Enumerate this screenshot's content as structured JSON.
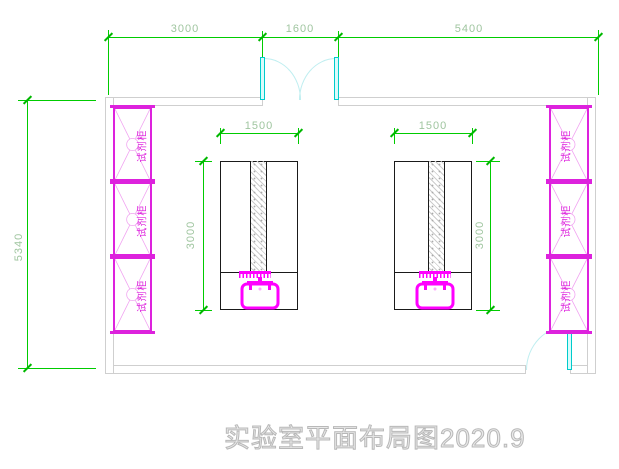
{
  "drawing": {
    "title": "实验室平面布局图2020.9",
    "room": {
      "top_dimensions": [
        "3000",
        "1600",
        "5400"
      ],
      "left_dimension": "5340"
    },
    "benches": [
      {
        "width_label": "1500",
        "depth_label": "3000"
      },
      {
        "width_label": "1500",
        "depth_label": "3000"
      }
    ],
    "cabinet_label": "试剂柜",
    "colors": {
      "dimension_line": "#00cc00",
      "dimension_text": "#9fc59f",
      "cabinet": "#dd22dd",
      "fixture": "#ff00ff",
      "door": "#00cccc",
      "door_arc": "#bfeef0",
      "wall": "#cfcfcf",
      "bench_outline": "#1a1a1a",
      "title_text": "#b8b8b8"
    }
  }
}
